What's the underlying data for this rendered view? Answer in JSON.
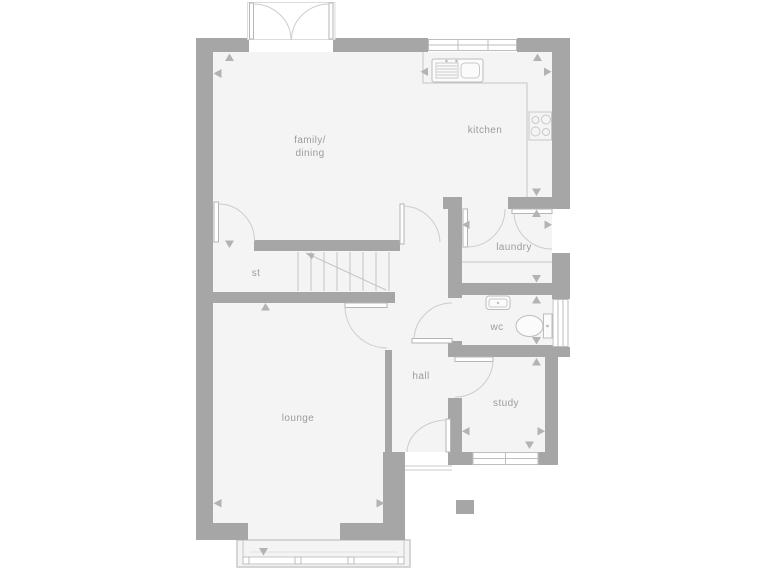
{
  "plan": {
    "colors": {
      "wall": "#a6a6a6",
      "floor": "#f4f4f4",
      "detail_line": "#c6c6c6",
      "fixture_line": "#bdbdbd",
      "label": "#9c9c9c",
      "marker": "#b3b3b3",
      "background": "#ffffff"
    },
    "rooms": [
      {
        "name": "family-dining",
        "label1": "family/",
        "label2": "dining"
      },
      {
        "name": "kitchen",
        "label": "kitchen"
      },
      {
        "name": "laundry",
        "label": "laundry"
      },
      {
        "name": "store",
        "label": "st"
      },
      {
        "name": "wc",
        "label": "wc"
      },
      {
        "name": "hall",
        "label": "hall"
      },
      {
        "name": "study",
        "label": "study"
      },
      {
        "name": "lounge",
        "label": "lounge"
      }
    ],
    "fixtures": [
      "french-doors",
      "kitchen-window",
      "kitchen-sink",
      "kitchen-worktop",
      "hob",
      "laundry-worktop",
      "back-door",
      "wc-basin",
      "toilet",
      "wc-window",
      "stairs",
      "stairs-up-arrow",
      "front-door",
      "porch-step",
      "study-window",
      "bay-window"
    ]
  }
}
